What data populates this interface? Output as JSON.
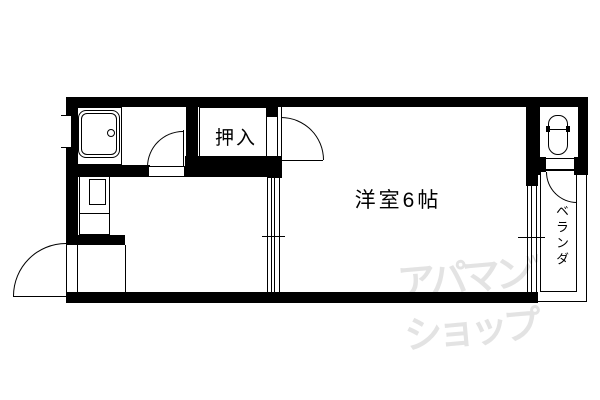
{
  "floor_plan": {
    "title": "apartment-floor-plan",
    "rooms": {
      "closet": {
        "label": "押入"
      },
      "main_room": {
        "label": "洋室6帖"
      },
      "balcony": {
        "label": "ベランダ"
      }
    },
    "fixtures": {
      "kitchen_sink": "sink-with-faucet-icon",
      "toilet": "toilet-bowl-icon"
    },
    "doors": {
      "entrance": "swing-out-door",
      "kitchen": "swing-door",
      "main_room": "swing-door",
      "toilet": "swing-door",
      "hall_to_main": "sliding-door",
      "main_window": "sliding-window"
    },
    "watermark": {
      "line1": "アパマン",
      "mark": "w",
      "line2": "ショップ"
    },
    "colors": {
      "wall": "#000000",
      "background": "#ffffff",
      "watermark": "#e3e3e3"
    }
  }
}
